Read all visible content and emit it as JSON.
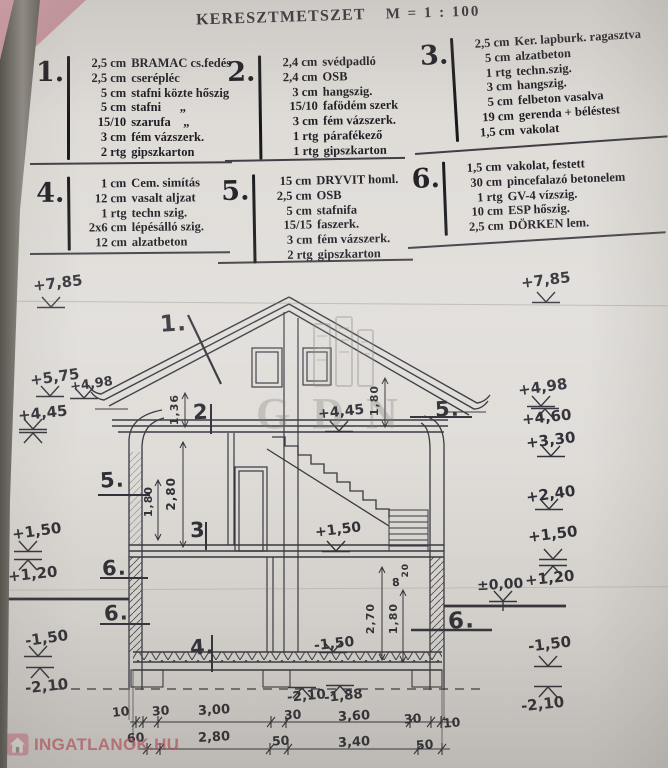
{
  "title": {
    "text": "KERESZTMETSZET",
    "scale": "M = 1 : 100"
  },
  "legend": [
    {
      "no": "1.",
      "items": [
        {
          "q": "2,5 cm",
          "n": "BRAMAC cs.fedés"
        },
        {
          "q": "2,5 cm",
          "n": "cserépléc"
        },
        {
          "q": "5 cm",
          "n": "stafni közte hőszig"
        },
        {
          "q": "5 cm",
          "n": "stafni      „"
        },
        {
          "q": "15/10",
          "n": "szarufa    „"
        },
        {
          "q": "3 cm",
          "n": "fém vázszerk."
        },
        {
          "q": "2 rtg",
          "n": "gipszkarton"
        }
      ]
    },
    {
      "no": "2.",
      "items": [
        {
          "q": "2,4 cm",
          "n": "svédpadló"
        },
        {
          "q": "2,4 cm",
          "n": "OSB"
        },
        {
          "q": "3 cm",
          "n": "hangszig."
        },
        {
          "q": "15/10",
          "n": "fafödém szerk"
        },
        {
          "q": "3 cm",
          "n": "fém vázszerk."
        },
        {
          "q": "1 rtg",
          "n": "párafékező"
        },
        {
          "q": "1 rtg",
          "n": "gipszkarton"
        }
      ]
    },
    {
      "no": "3.",
      "items": [
        {
          "q": "2,5 cm",
          "n": "Ker. lapburk. ragasztva"
        },
        {
          "q": "5 cm",
          "n": "alzatbeton"
        },
        {
          "q": "1 rtg",
          "n": "techn.szig."
        },
        {
          "q": "3 cm",
          "n": "hangszig."
        },
        {
          "q": "5 cm",
          "n": "felbeton vasalva"
        },
        {
          "q": "19 cm",
          "n": "gerenda + béléstest"
        },
        {
          "q": "1,5 cm",
          "n": "vakolat"
        }
      ]
    },
    {
      "no": "4.",
      "items": [
        {
          "q": "1 cm",
          "n": "Cem. simítás"
        },
        {
          "q": "12 cm",
          "n": "vasalt aljzat"
        },
        {
          "q": "1 rtg",
          "n": "techn szig."
        },
        {
          "q": "2x6 cm",
          "n": "lépésálló szig."
        },
        {
          "q": "12 cm",
          "n": "alzatbeton"
        }
      ]
    },
    {
      "no": "5.",
      "items": [
        {
          "q": "15 cm",
          "n": "DRYVIT homl."
        },
        {
          "q": "2,5 cm",
          "n": "OSB"
        },
        {
          "q": "5 cm",
          "n": "stafnifa"
        },
        {
          "q": "15/15",
          "n": "faszerk."
        },
        {
          "q": "3 cm",
          "n": "fém vázszerk."
        },
        {
          "q": "2 rtg",
          "n": "gipszkarton"
        }
      ]
    },
    {
      "no": "6.",
      "items": [
        {
          "q": "1,5 cm",
          "n": "vakolat, festett"
        },
        {
          "q": "30 cm",
          "n": "pincefalazó betonelem"
        },
        {
          "q": "1 rtg",
          "n": "GV-4 vízszig."
        },
        {
          "q": "10 cm",
          "n": "ESP hőszig."
        },
        {
          "q": "2,5 cm",
          "n": "DÖRKEN lem."
        }
      ]
    }
  ],
  "levels_left": [
    "+7,85",
    "+5,75",
    "+4,98",
    "+4,45",
    "+1,50",
    "+1,20",
    "-1,50",
    "-2,10"
  ],
  "levels_right": [
    "+7,85",
    "+4,98",
    "+4,60",
    "+3,30",
    "+2,40",
    "+1,50",
    "+1,20",
    "±0,00",
    "-1,50",
    "-2,10"
  ],
  "levels_inner": [
    "+4,45",
    "+1,50",
    "-1,50",
    "-2,10",
    "-1,88"
  ],
  "callouts": [
    "1.",
    "2",
    "3",
    "4.",
    "5.",
    "6.",
    "6.",
    "5.",
    "6."
  ],
  "dims_vertical": [
    "1,36",
    "1,80",
    "2,80",
    "1,80",
    "2,70",
    "1,80"
  ],
  "dims_small": [
    "20",
    "8"
  ],
  "chain_top": [
    "10",
    "30",
    "3,00",
    "30",
    "3,60",
    "30",
    "10"
  ],
  "chain_bottom": [
    "60",
    "2,80",
    "50",
    "3,40",
    "50"
  ],
  "watermark": {
    "text": "GDN"
  },
  "brand": {
    "name": "INGATLANOK.HU",
    "color": "#c64d58"
  },
  "colors": {
    "paper": "#dfdcd8",
    "ink": "#2b2a31",
    "brand_pink": "#dd8894"
  }
}
